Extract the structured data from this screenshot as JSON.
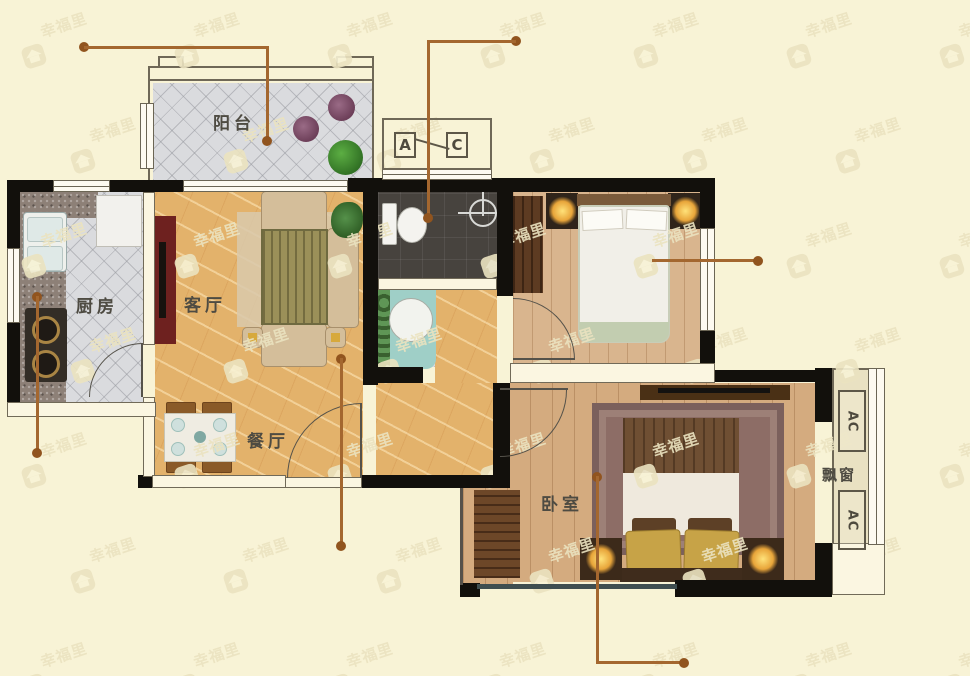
{
  "brand_watermark": "幸福里",
  "rooms": {
    "balcony": "阳台",
    "kitchen": "厨房",
    "living_room": "客厅",
    "dining_room": "餐厅",
    "bedroom": "卧室",
    "bay_window": "飘窗"
  },
  "symbols": {
    "ac_letter_a": "A",
    "ac_letter_c": "C",
    "ac_vertical": "AC"
  },
  "colors": {
    "background": "#f8f3d6",
    "wall": "#12100c",
    "leader_line": "#a4672f",
    "marble_floor": "#e3b26b",
    "wood_floor": "#d8b38c",
    "tile_floor": "#dadbde",
    "shower_floor": "#47433e",
    "watermark": "#ebe3c0"
  }
}
